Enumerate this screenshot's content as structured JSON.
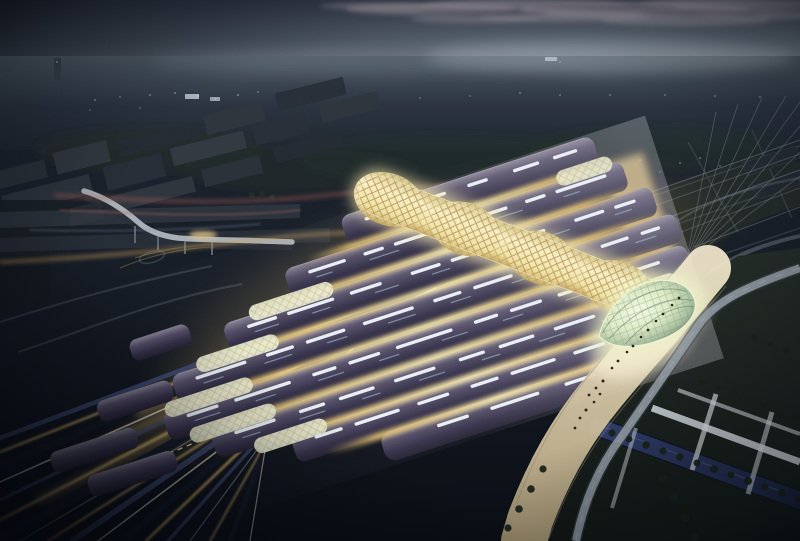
{
  "palette": {
    "sky": {
      "top": "#3b4250",
      "mid": "#5d6874",
      "horizon": "#848f99",
      "cloud": "#9b95a0",
      "cloud_dark": "#51505c"
    },
    "land": {
      "haze": "#4e5a65",
      "far": "#2b3440",
      "deep": "#1c232e",
      "ground": "#0b0f16",
      "block": "#2e353d",
      "lawn": "#242c28",
      "lawn_deep": "#121815",
      "tree": "#182219"
    },
    "station": {
      "vault_hi": "#8a8496",
      "vault_mid": "#554f68",
      "vault_dark": "#252233",
      "vault_edge": "#bdb7c6",
      "skylight": "#e9eff4",
      "skylight_cool": "#a9c8d9",
      "glow_core": "#f7e9b0",
      "glow_warm": "#dfbe74",
      "end_wall": "#e8c87e",
      "shell": "#ecefd6",
      "spine_light": "#f8efc8",
      "spine_gold": "#c9ab66",
      "lattice": "#b3924a",
      "dome_core": "#f4f8e2",
      "dome_mid": "#dde9c4",
      "dome_edge": "#7d947c",
      "dome_line": "#5e7160"
    },
    "circulation": {
      "road": "#9aa3ab",
      "ramp": "#a8b0b6",
      "path": "#cfd6da",
      "plaza": "#f2e8cc",
      "plaza_deep": "#b9a67e",
      "pool": "#32406e",
      "pool_deep": "#1a2340",
      "rail_warm": "#d2af66",
      "rail_pale": "#e6e0c8",
      "rail_cool": "#44507a",
      "rail_dark": "#141a26",
      "rail_steel": "#97a0b2",
      "trail_red": "#ad6258",
      "trail_warm": "#c9a05e",
      "trail_cool": "#7e93a8",
      "people": "#2b241e",
      "train_window": "#eedfa8"
    },
    "fx": {
      "light_dot": "#dde6ee",
      "catenary": "#8a939e",
      "far_rail": "#6d7884"
    }
  },
  "station_info": {
    "vault_count": 8,
    "glass_shell_count": 7,
    "dome_count": 1
  }
}
